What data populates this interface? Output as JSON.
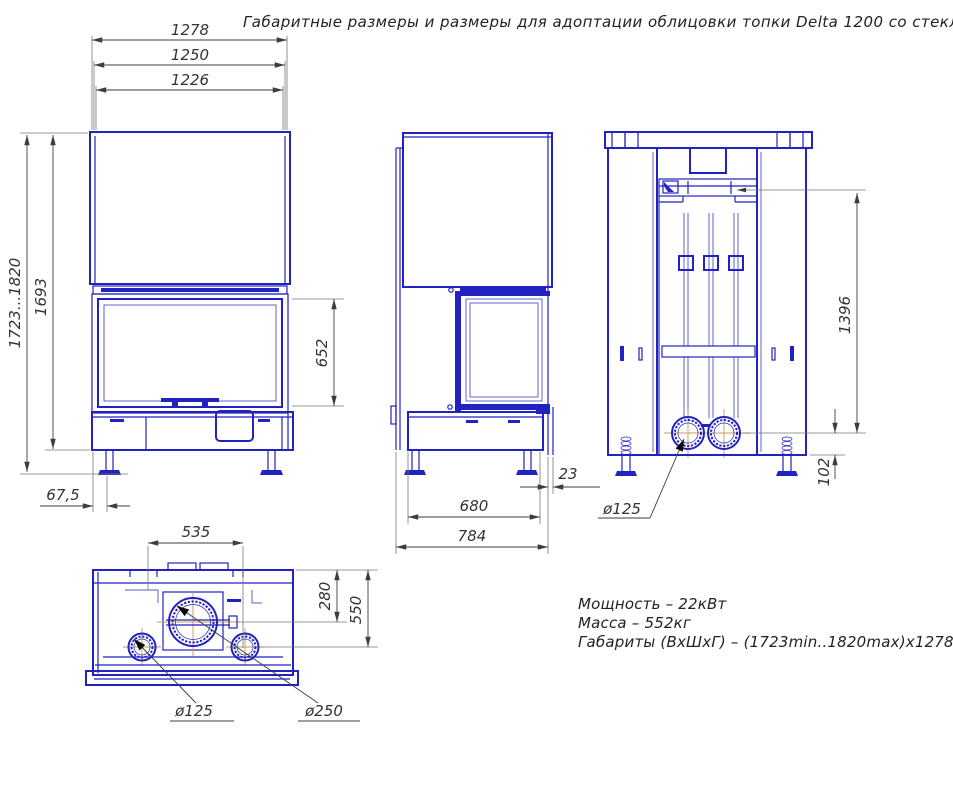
{
  "title": "Габаритные размеры и размеры для адоптации облицовки топки Delta 1200 со стеклом 1200x600x450",
  "dims": {
    "front": {
      "width_overall": "1278",
      "width_frame": "1250",
      "width_glass": "1226",
      "height_range": "1723...1820",
      "height_body": "1693",
      "glass_height": "652",
      "leg_inset": "67,5"
    },
    "side": {
      "depth_base": "680",
      "depth_overall": "784",
      "rear_lip": "23"
    },
    "back": {
      "connector_height": "1396",
      "port_offset": "102",
      "port_diameter": "ø125"
    },
    "plan": {
      "flue_offset": "535",
      "flue_depth": "280",
      "ports_depth": "550",
      "port_diameter": "ø125",
      "flue_diameter": "ø250"
    }
  },
  "specs": {
    "power": "Мощность – 22кВт",
    "mass": "Масса – 552кг",
    "overall": "Габариты (ВхШхГ) – (1723min..1820max)x1278x784"
  },
  "colors": {
    "line_blue": "#2222c0",
    "dimension_gray": "#3d3d3d",
    "centerline_tan": "#c89a5e",
    "background": "#ffffff"
  }
}
